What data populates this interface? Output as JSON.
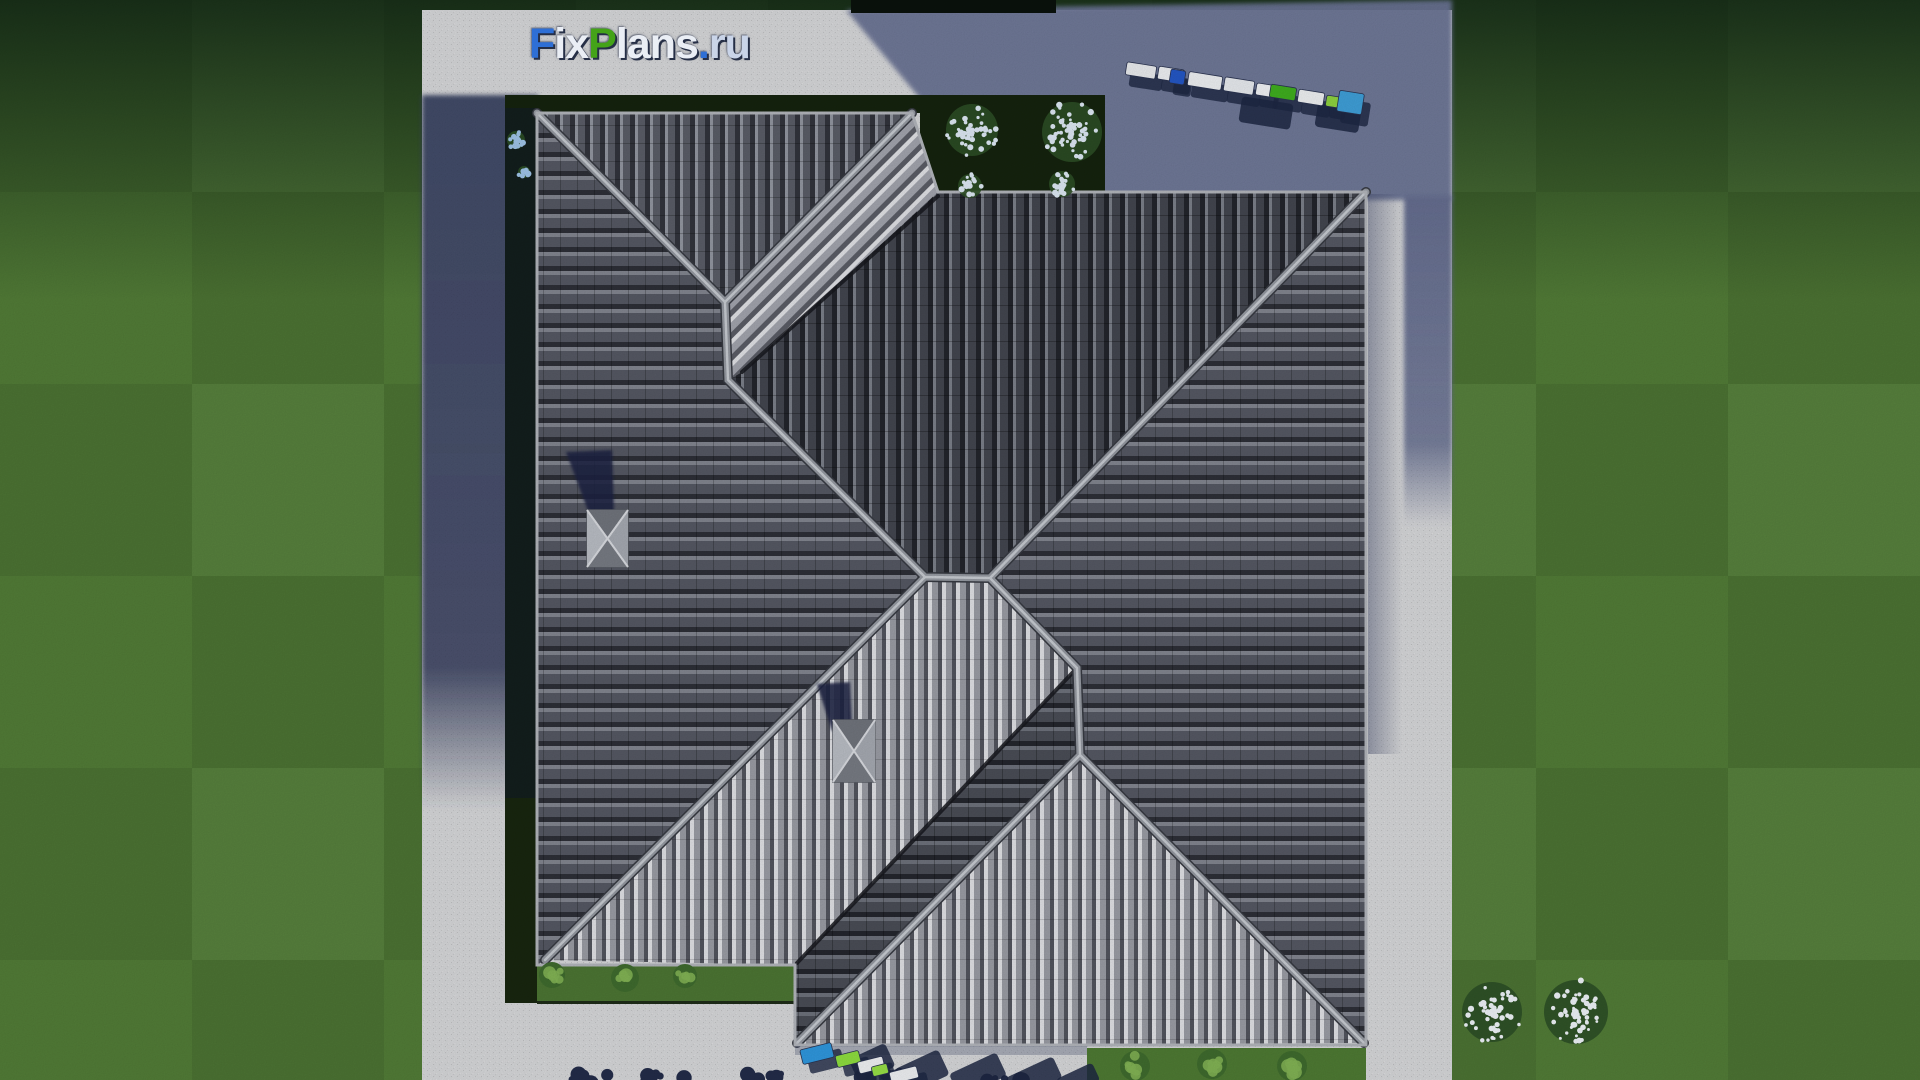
{
  "watermark": {
    "text": "FixPlans.ru",
    "segments": [
      {
        "text": "F",
        "color": "#2e6fd6"
      },
      {
        "text": "ix",
        "color": "#eaeef5"
      },
      {
        "text": "P",
        "color": "#44a318"
      },
      {
        "text": "lans",
        "color": "#eaeef5"
      },
      {
        "text": ".",
        "color": "#2e6fd6"
      },
      {
        "text": "ru",
        "color": "#c9d4e8"
      }
    ]
  },
  "environment": {
    "lawn_green": "#527c37",
    "pavement_light": "#d6d7d9",
    "pavement_shadow": "#6a7394",
    "hedge_dark": "#15230e",
    "roof_dark": "#43464f",
    "roof_medium": "#555863",
    "roof_sunlit": "#9a9ca4",
    "ridge_cap": "#9599a1",
    "shadow_navy": "#1d2742"
  },
  "cars": {
    "shadow_color": "#1d2742",
    "top_row": [
      {
        "x": 1126,
        "y": 64,
        "w": 30,
        "h": 13,
        "angle": 9,
        "color": "#e9ebee"
      },
      {
        "x": 1158,
        "y": 68,
        "w": 26,
        "h": 13,
        "angle": 9,
        "color": "#eef0f3"
      },
      {
        "x": 1170,
        "y": 70,
        "w": 15,
        "h": 14,
        "angle": 9,
        "color": "#2457c5"
      },
      {
        "x": 1188,
        "y": 74,
        "w": 34,
        "h": 14,
        "angle": 9,
        "color": "#eef0f3"
      },
      {
        "x": 1224,
        "y": 79,
        "w": 30,
        "h": 14,
        "angle": 9,
        "color": "#e7eaee"
      },
      {
        "x": 1256,
        "y": 84,
        "w": 16,
        "h": 12,
        "angle": 9,
        "color": "#f1f3f6"
      },
      {
        "x": 1270,
        "y": 86,
        "w": 26,
        "h": 13,
        "angle": 9,
        "color": "#3fae1f"
      },
      {
        "x": 1298,
        "y": 91,
        "w": 26,
        "h": 13,
        "angle": 9,
        "color": "#eef0f2"
      },
      {
        "x": 1326,
        "y": 96,
        "w": 13,
        "h": 11,
        "angle": 9,
        "color": "#8ed23f"
      },
      {
        "x": 1338,
        "y": 92,
        "w": 25,
        "h": 21,
        "angle": 9,
        "color": "#3f9fd8"
      }
    ],
    "bottom_row": [
      {
        "x": 801,
        "y": 1046,
        "w": 32,
        "h": 15,
        "angle": -14,
        "color": "#2f97dd"
      },
      {
        "x": 836,
        "y": 1053,
        "w": 24,
        "h": 12,
        "angle": -14,
        "color": "#8ede3f"
      },
      {
        "x": 858,
        "y": 1059,
        "w": 26,
        "h": 12,
        "angle": -14,
        "color": "#eff1f4"
      },
      {
        "x": 872,
        "y": 1065,
        "w": 16,
        "h": 10,
        "angle": -14,
        "color": "#96df46"
      },
      {
        "x": 890,
        "y": 1069,
        "w": 28,
        "h": 12,
        "angle": -14,
        "color": "#eef0f3"
      }
    ],
    "shadow_blobs": [
      {
        "x": 1240,
        "y": 100,
        "w": 52,
        "h": 26,
        "angle": 9
      },
      {
        "x": 1316,
        "y": 106,
        "w": 44,
        "h": 24,
        "angle": 9
      },
      {
        "x": 852,
        "y": 1050,
        "w": 40,
        "h": 26,
        "angle": -25
      },
      {
        "x": 898,
        "y": 1058,
        "w": 48,
        "h": 28,
        "angle": -25
      },
      {
        "x": 952,
        "y": 1062,
        "w": 52,
        "h": 26,
        "angle": -25
      },
      {
        "x": 1008,
        "y": 1066,
        "w": 52,
        "h": 24,
        "angle": -25
      },
      {
        "x": 1058,
        "y": 1070,
        "w": 40,
        "h": 20,
        "angle": -25
      }
    ]
  },
  "vegetation": {
    "flower_bushes": [
      {
        "cx": 972,
        "cy": 130,
        "r": 26,
        "petals": "#dde8f4"
      },
      {
        "cx": 1072,
        "cy": 132,
        "r": 30,
        "petals": "#dde8f4"
      },
      {
        "cx": 970,
        "cy": 186,
        "r": 12,
        "petals": "#dde8f4"
      },
      {
        "cx": 1062,
        "cy": 184,
        "r": 13,
        "petals": "#dde8f4"
      },
      {
        "cx": 1492,
        "cy": 1012,
        "r": 30,
        "petals": "#eef3f8"
      },
      {
        "cx": 1576,
        "cy": 1012,
        "r": 32,
        "petals": "#eef3f8"
      },
      {
        "cx": 516,
        "cy": 140,
        "r": 9,
        "petals": "#9fc4e8"
      },
      {
        "cx": 524,
        "cy": 172,
        "r": 6,
        "petals": "#9fc4e8"
      }
    ],
    "green_bushes": [
      {
        "cx": 552,
        "cy": 975,
        "r": 13
      },
      {
        "cx": 625,
        "cy": 978,
        "r": 14
      },
      {
        "cx": 685,
        "cy": 976,
        "r": 12
      },
      {
        "cx": 1135,
        "cy": 1066,
        "r": 15
      },
      {
        "cx": 1212,
        "cy": 1064,
        "r": 15
      },
      {
        "cx": 1292,
        "cy": 1066,
        "r": 15
      }
    ],
    "bush_green": "#82b354",
    "tree_silhouettes": [
      {
        "cx": 585,
        "cy": 1074
      },
      {
        "cx": 665,
        "cy": 1072
      },
      {
        "cx": 760,
        "cy": 1070
      },
      {
        "cx": 880,
        "cy": 1074
      },
      {
        "cx": 1000,
        "cy": 1076
      }
    ],
    "tree_color": "#232c49"
  }
}
